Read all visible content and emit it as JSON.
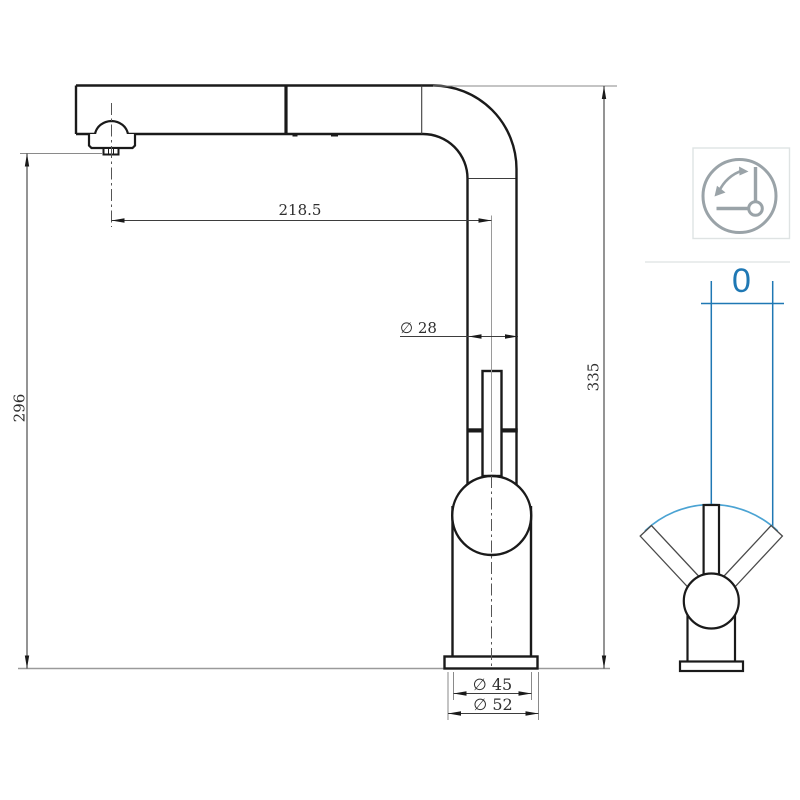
{
  "drawing": {
    "type": "faucet-technical-dimension-drawing",
    "main_view": {
      "dims": {
        "spout_reach": "218.5",
        "pipe_diameter": "∅ 28",
        "outlet_height": "296",
        "total_height": "335",
        "body_diameter": "∅ 45",
        "base_diameter": "∅ 52"
      }
    },
    "side_view": {
      "swivel_value": "0"
    },
    "icon": {
      "name": "swivel-angle-icon"
    },
    "colors": {
      "outline": "#1a1a1a",
      "dimension_line": "#3d3d3d",
      "ground_line": "#9a9a9a",
      "accent_blue": "#1f78b4",
      "accent_blue_light": "#4ba3d3",
      "icon_gray": "#9aa3a8",
      "box_border": "#dfe3e3"
    }
  }
}
